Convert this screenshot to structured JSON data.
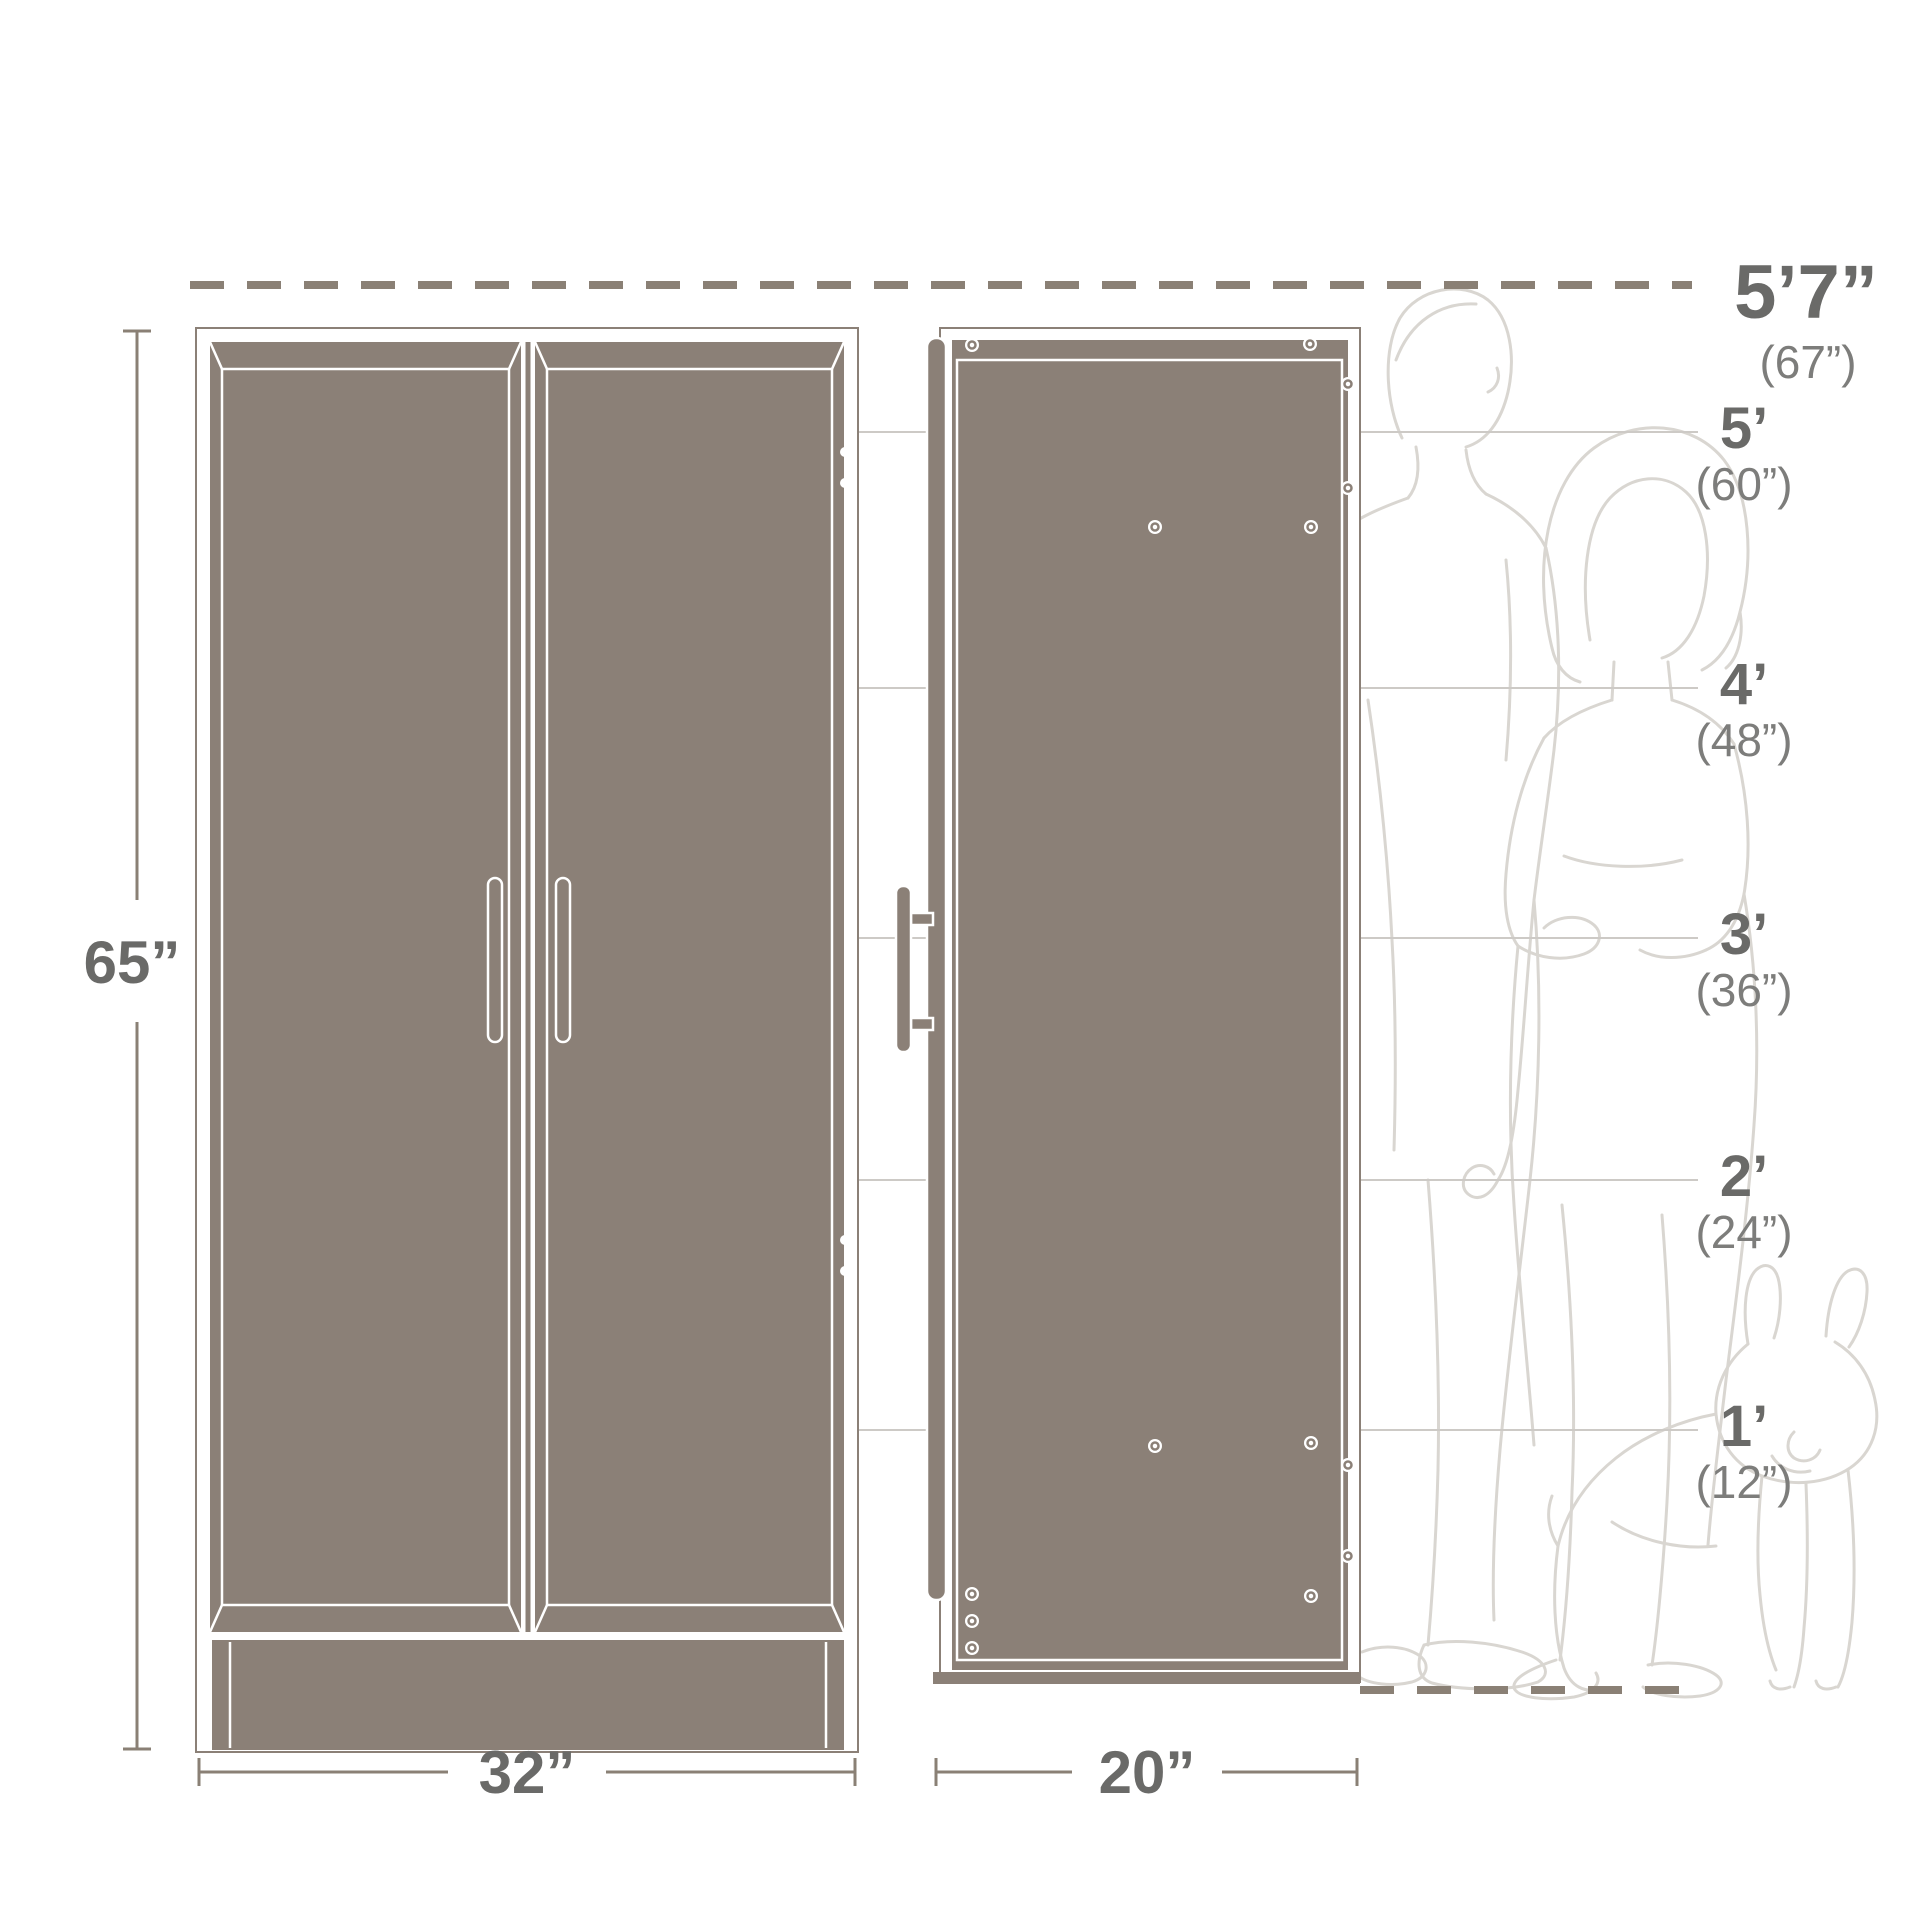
{
  "dimensions": {
    "height": "65”",
    "width": "32”",
    "depth": "20”"
  },
  "height_scale": {
    "max": {
      "feet": "5’7”",
      "inches": "(67”)"
    },
    "ticks": [
      {
        "feet": "5’",
        "inches": "(60”)"
      },
      {
        "feet": "4’",
        "inches": "(48”)"
      },
      {
        "feet": "3’",
        "inches": "(36”)"
      },
      {
        "feet": "2’",
        "inches": "(24”)"
      },
      {
        "feet": "1’",
        "inches": "(12”)"
      }
    ]
  },
  "figures": [
    "man-outline",
    "woman-outline",
    "dog-outline"
  ],
  "colors": {
    "cabinet_fill": "#8b8077",
    "outline_white": "#ffffff",
    "dimension_line": "#8a8075",
    "label_dark": "#6a6a68",
    "label_muted": "#7d7d7b",
    "reference_line": "#cdcac6",
    "figure_line": "#d9d6d1"
  }
}
